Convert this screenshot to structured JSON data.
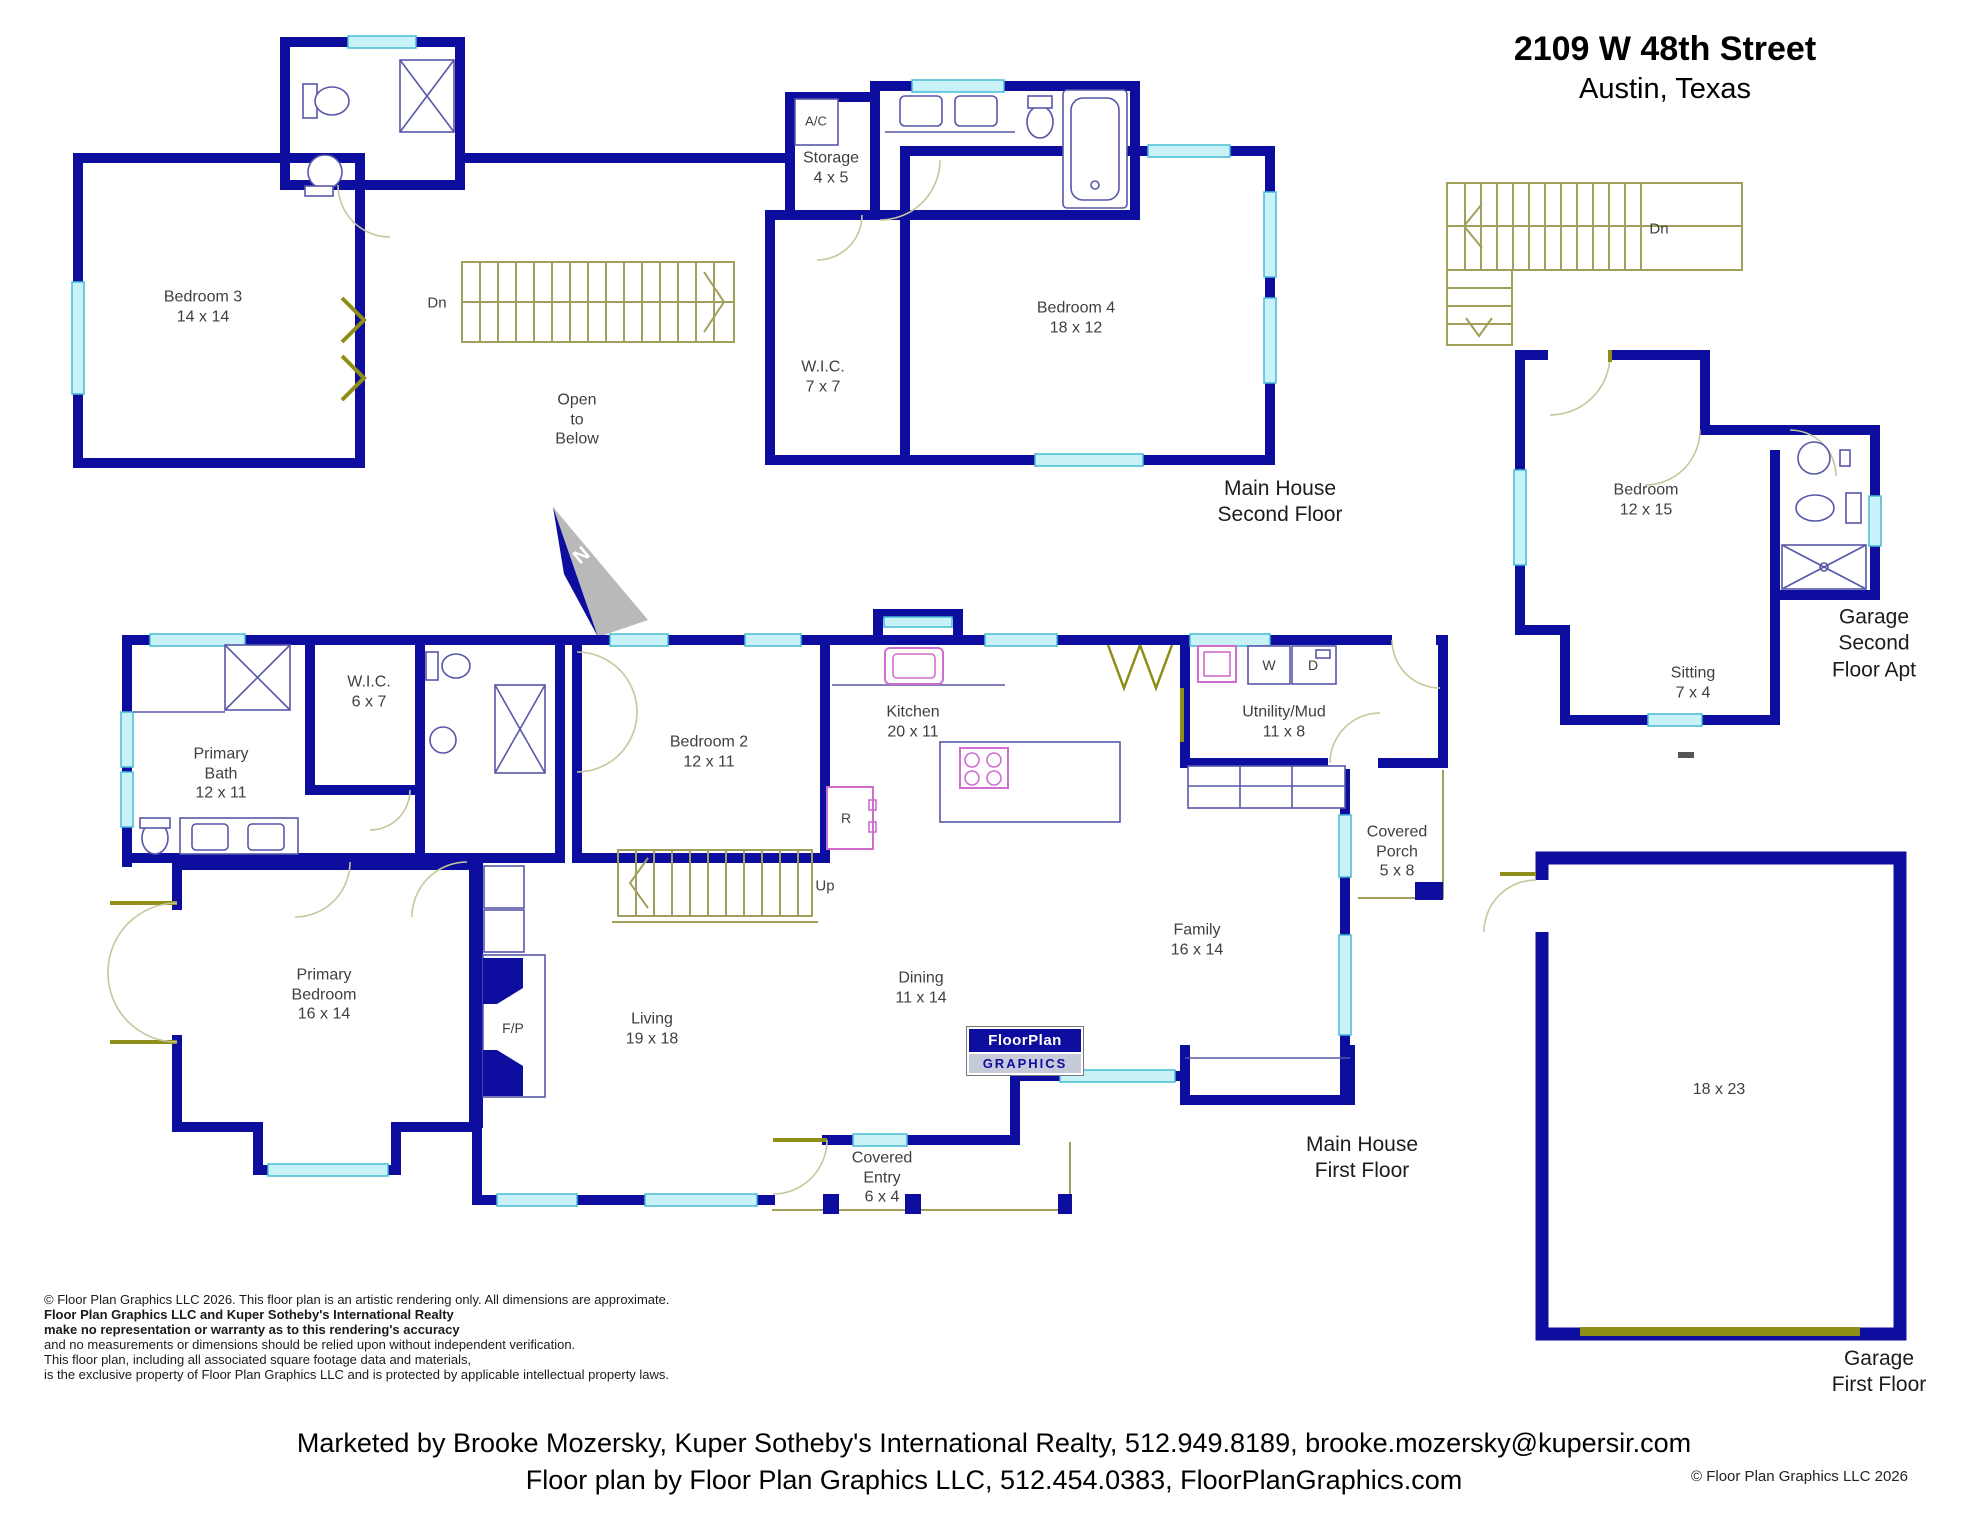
{
  "header": {
    "address": "2109 W 48th Street",
    "city": "Austin, Texas"
  },
  "sections": {
    "main_second": "Main House\nSecond Floor",
    "main_first": "Main House\nFirst Floor",
    "garage_apt": "Garage\nSecond Floor Apt",
    "garage_first": "Garage\nFirst Floor"
  },
  "rooms": {
    "bedroom3": {
      "name": "Bedroom 3",
      "dims": "14 x 14"
    },
    "storage": {
      "name": "Storage",
      "dims": "4 x 5"
    },
    "wic_second": {
      "name": "W.I.C.",
      "dims": "7 x 7"
    },
    "bedroom4": {
      "name": "Bedroom 4",
      "dims": "18 x 12"
    },
    "open_to_below": {
      "name": "Open\nto\nBelow",
      "dims": ""
    },
    "apt_bedroom": {
      "name": "Bedroom",
      "dims": "12 x 15"
    },
    "sitting": {
      "name": "Sitting",
      "dims": "7 x 4"
    },
    "primary_bath": {
      "name": "Primary\nBath",
      "dims": "12 x 11"
    },
    "wic_first": {
      "name": "W.I.C.",
      "dims": "6 x 7"
    },
    "bedroom2": {
      "name": "Bedroom 2",
      "dims": "12 x 11"
    },
    "kitchen": {
      "name": "Kitchen",
      "dims": "20 x 11"
    },
    "utility": {
      "name": "Utnility/Mud",
      "dims": "11 x 8"
    },
    "covered_porch": {
      "name": "Covered\nPorch",
      "dims": "5 x 8"
    },
    "family": {
      "name": "Family",
      "dims": "16 x 14"
    },
    "dining": {
      "name": "Dining",
      "dims": "11 x 14"
    },
    "living": {
      "name": "Living",
      "dims": "19 x 18"
    },
    "primary_bedroom": {
      "name": "Primary\nBedroom",
      "dims": "16 x 14"
    },
    "covered_entry": {
      "name": "Covered\nEntry",
      "dims": "6 x 4"
    },
    "garage": {
      "name": "",
      "dims": "18 x 23"
    }
  },
  "markers": {
    "dn_main": "Dn",
    "dn_garage": "Dn",
    "up_first": "Up",
    "ac": "A/C",
    "fridge": "R",
    "washer": "W",
    "dryer": "D",
    "fireplace": "F/P",
    "north": "N"
  },
  "logo": {
    "line1": "FloorPlan",
    "line2": "GRAPHICS"
  },
  "disclaimer": {
    "l1": "© Floor Plan Graphics LLC 2026. This floor plan is an artistic rendering only. All dimensions are approximate.",
    "l2": "Floor Plan Graphics LLC and Kuper Sotheby's International Realty",
    "l3": "make no representation or warranty as to this rendering's accuracy",
    "l4": "and no measurements or dimensions should be relied upon without independent verification.",
    "l5": "This floor plan, including all associated square footage data and materials,",
    "l6": "is the exclusive property of Floor Plan Graphics LLC and is protected by applicable intellectual property laws."
  },
  "footer": {
    "marketing": "Marketed by Brooke Mozersky, Kuper Sotheby's International Realty, 512.949.8189, brooke.mozersky@kupersir.com",
    "credit": "Floor plan by Floor Plan Graphics LLC, 512.454.0383, FloorPlanGraphics.com",
    "copyright": "© Floor Plan Graphics LLC 2026"
  },
  "colors": {
    "wall": "#0d0d9f",
    "window": "#c9f2f8",
    "door_jamb": "#8f8f17",
    "stairs": "#a0a05c",
    "appliance": "#cf6ecf"
  }
}
